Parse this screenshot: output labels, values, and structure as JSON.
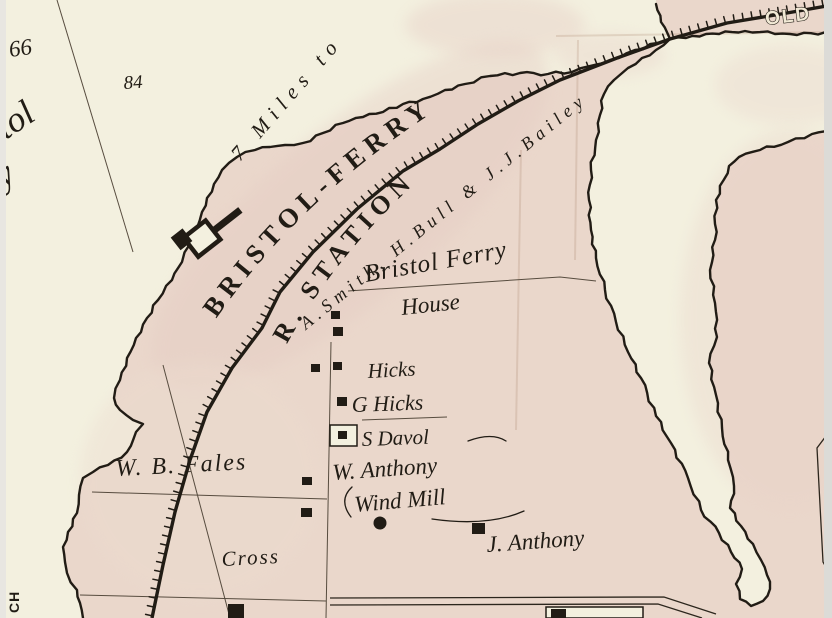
{
  "map": {
    "description": "Historical atlas map detail of Bristol Ferry",
    "labels": {
      "plot66": "66",
      "plot84": "84",
      "bristol_partial": "stol",
      "ferry_partial": "ry",
      "miles": "7 Miles to",
      "bristol_ferry_rr": "BRISTOL-FERRY",
      "r_station": "R. STATION",
      "smith_bull_bailey": "A.Smith, H.Bull & J.J.Bailey",
      "bristol_ferry_house_1": "Bristol Ferry",
      "bristol_ferry_house_2": "House",
      "hicks": "Hicks",
      "g_hicks": "G Hicks",
      "s_davol": "S Davol",
      "w_anthony": "W. Anthony",
      "wind_mill": "Wind Mill",
      "wb_fales": "W. B. Fales",
      "cross": "Cross",
      "j_anthony": "J. Anthony",
      "old": "OLD",
      "ch": "CH"
    },
    "colors": {
      "water": "#f3f0df",
      "land": "#ead7cb",
      "land_deep": "#e3cabf",
      "ink": "#211c15",
      "boundary": "#574c3f",
      "paper": "#f1e9d5"
    }
  }
}
